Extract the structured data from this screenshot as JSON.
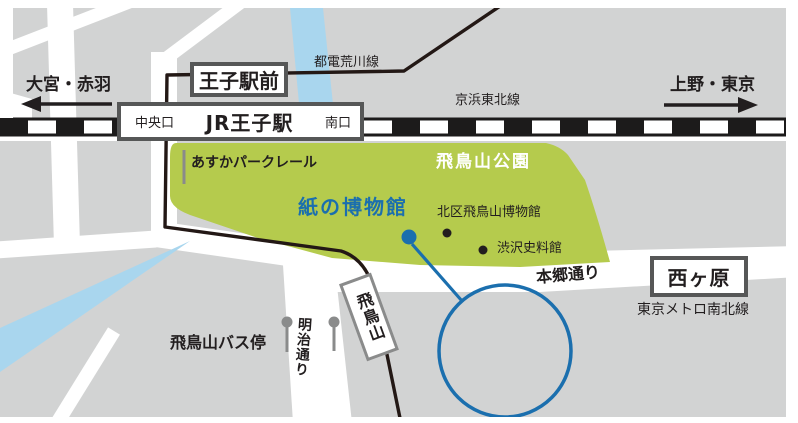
{
  "colors": {
    "accent_blue": "#1b6fae",
    "park_green": "#b5cb4d",
    "river_blue": "#a9d6ee",
    "block_gray": "#d2d3d3",
    "line_dark": "#231815",
    "text_dark": "#221e1f",
    "border_dark": "#565757",
    "pole_gray": "#8a8b8b"
  },
  "directions": {
    "west": "大宮・赤羽",
    "east": "上野・東京"
  },
  "lines": {
    "toden_arakawa": "都電荒川線",
    "keihin_tohoku": "京浜東北線",
    "namboku": "東京メトロ南北線",
    "park_rail": "あすかパークレール"
  },
  "stations": {
    "oji_ekimae": "王子駅前",
    "jr_oji": "JR王子駅",
    "jr_oji_central_exit": "中央口",
    "jr_oji_south_exit": "南口",
    "nishigahara": "西ヶ原",
    "asukayama_tram_stop": "飛鳥山"
  },
  "park": {
    "name": "飛鳥山公園"
  },
  "places": {
    "paper_museum": "紙の博物館",
    "kita_asukayama_museum": "北区飛鳥山博物館",
    "shibusawa_memorial_museum": "渋沢史料館",
    "asukayama_bus_stop": "飛鳥山バス停"
  },
  "roads": {
    "hongo_dori": "本郷通り",
    "meiji_dori": "明治通り"
  }
}
